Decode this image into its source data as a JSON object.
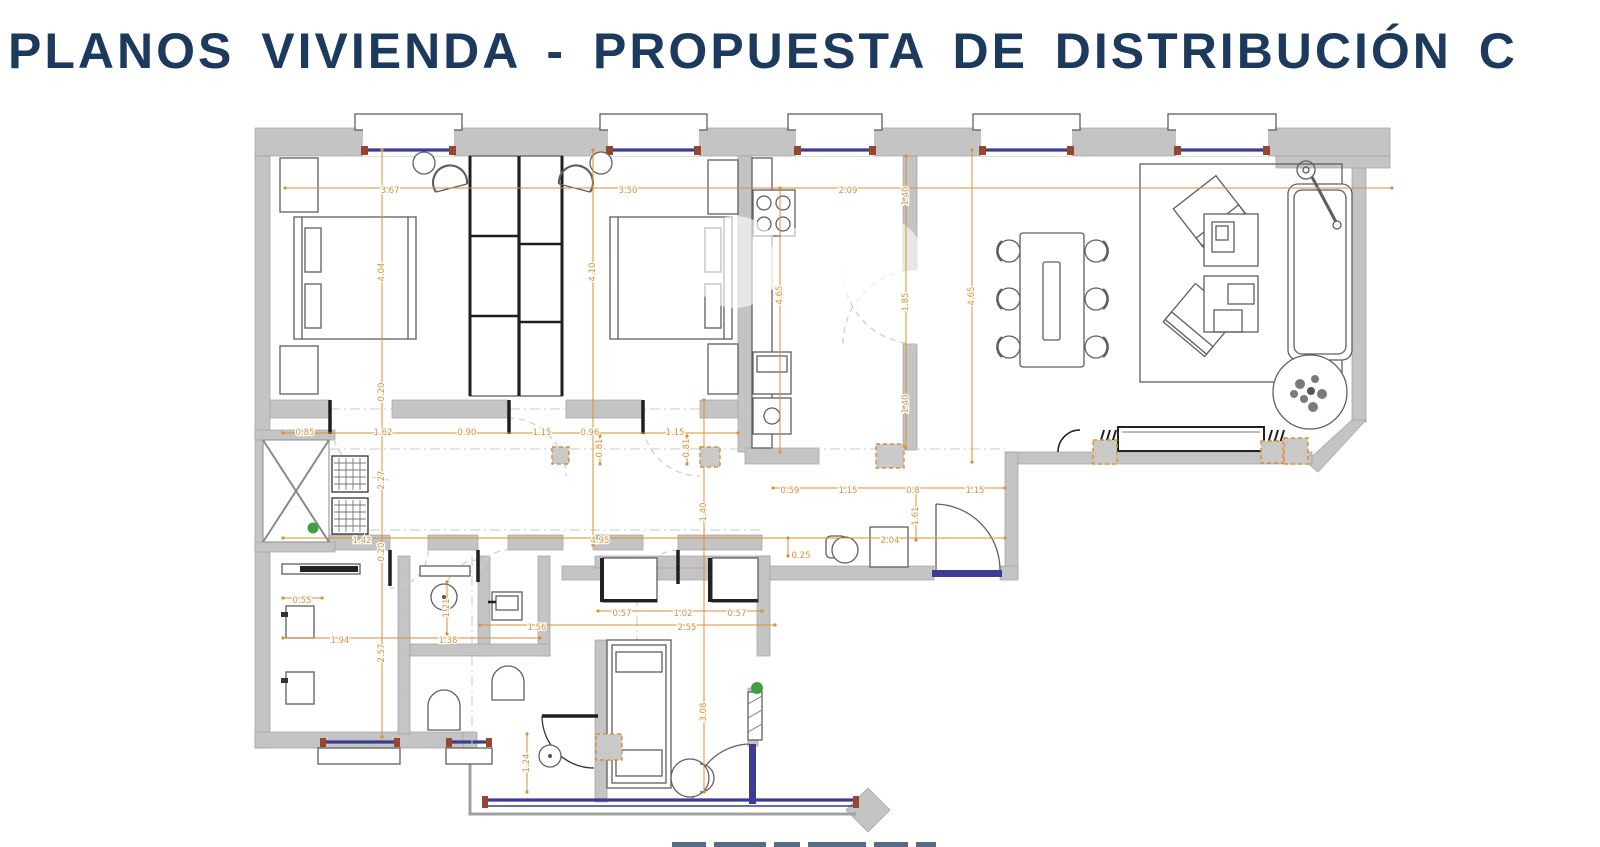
{
  "title": "PLANOS VIVIENDA - PROPUESTA DE DISTRIBUCIÓN C",
  "colors": {
    "title_navy": "#1c3a5e",
    "wall_gray": "#c4c4c4",
    "dimension_orange": "#dd8f33",
    "glazing_blue": "#3c3c96",
    "frame_maroon": "#96452f",
    "accent_green": "#3da23d"
  },
  "plan": {
    "dimensions": [
      {
        "t": "3.67",
        "x": 390,
        "y": 191
      },
      {
        "t": "3.50",
        "x": 628,
        "y": 191
      },
      {
        "t": "2.09",
        "x": 848,
        "y": 191
      },
      {
        "t": "4.04",
        "x": 382,
        "y": 272,
        "rot": 1
      },
      {
        "t": "0.20",
        "x": 382,
        "y": 392,
        "rot": 1
      },
      {
        "t": "2.27",
        "x": 382,
        "y": 480,
        "rot": 1
      },
      {
        "t": "0.20",
        "x": 382,
        "y": 552,
        "rot": 1
      },
      {
        "t": "2.57",
        "x": 382,
        "y": 653,
        "rot": 1
      },
      {
        "t": "4.10",
        "x": 593,
        "y": 272,
        "rot": 1
      },
      {
        "t": "1.40",
        "x": 906,
        "y": 196,
        "rot": 1
      },
      {
        "t": "1.85",
        "x": 906,
        "y": 302,
        "rot": 1
      },
      {
        "t": "1.40",
        "x": 906,
        "y": 404,
        "rot": 1
      },
      {
        "t": "4.65",
        "x": 780,
        "y": 295,
        "rot": 1
      },
      {
        "t": "4.65",
        "x": 972,
        "y": 296,
        "rot": 1
      },
      {
        "t": "0.85",
        "x": 305,
        "y": 433
      },
      {
        "t": "1.62",
        "x": 383,
        "y": 433
      },
      {
        "t": "0.90",
        "x": 467,
        "y": 433
      },
      {
        "t": "1.15",
        "x": 542,
        "y": 433
      },
      {
        "t": "0.96",
        "x": 590,
        "y": 433
      },
      {
        "t": "1.15",
        "x": 675,
        "y": 433
      },
      {
        "t": "0.81",
        "x": 600,
        "y": 448,
        "rot": 1
      },
      {
        "t": "0.81",
        "x": 687,
        "y": 448,
        "rot": 1
      },
      {
        "t": "1.40",
        "x": 704,
        "y": 512,
        "rot": 1
      },
      {
        "t": "3.08",
        "x": 704,
        "y": 712,
        "rot": 1
      },
      {
        "t": "1.24",
        "x": 527,
        "y": 763,
        "rot": 1
      },
      {
        "t": "1.61",
        "x": 916,
        "y": 516,
        "rot": 1
      },
      {
        "t": "0.59",
        "x": 790,
        "y": 491
      },
      {
        "t": "1.15",
        "x": 848,
        "y": 491
      },
      {
        "t": "0.8",
        "x": 913,
        "y": 491
      },
      {
        "t": "1.15",
        "x": 975,
        "y": 491
      },
      {
        "t": "1.42",
        "x": 362,
        "y": 541
      },
      {
        "t": "4.95",
        "x": 600,
        "y": 541
      },
      {
        "t": "2.04",
        "x": 890,
        "y": 541
      },
      {
        "t": "0.25",
        "x": 801,
        "y": 556
      },
      {
        "t": "0.55",
        "x": 302,
        "y": 601
      },
      {
        "t": "1.94",
        "x": 340,
        "y": 641
      },
      {
        "t": "1.38",
        "x": 448,
        "y": 641
      },
      {
        "t": "1.21",
        "x": 447,
        "y": 608,
        "rot": 1
      },
      {
        "t": "1.56",
        "x": 537,
        "y": 628
      },
      {
        "t": "2.55",
        "x": 687,
        "y": 628
      },
      {
        "t": "0.57",
        "x": 622,
        "y": 614
      },
      {
        "t": "1.02",
        "x": 683,
        "y": 614
      },
      {
        "t": "0.57",
        "x": 737,
        "y": 614
      }
    ],
    "dim_lines": [
      [
        285,
        188,
        1392,
        188
      ],
      [
        382,
        150,
        382,
        737
      ],
      [
        593,
        150,
        593,
        545
      ],
      [
        906,
        156,
        906,
        448
      ],
      [
        780,
        188,
        780,
        452
      ],
      [
        972,
        150,
        972,
        462
      ],
      [
        283,
        433,
        738,
        433
      ],
      [
        600,
        436,
        600,
        464
      ],
      [
        687,
        436,
        687,
        464
      ],
      [
        704,
        400,
        704,
        792
      ],
      [
        773,
        488,
        1005,
        488
      ],
      [
        916,
        492,
        916,
        540
      ],
      [
        283,
        538,
        1005,
        538
      ],
      [
        788,
        538,
        788,
        556
      ],
      [
        283,
        598,
        322,
        598
      ],
      [
        283,
        638,
        540,
        638
      ],
      [
        447,
        582,
        447,
        634
      ],
      [
        598,
        611,
        762,
        611
      ],
      [
        480,
        625,
        775,
        625
      ],
      [
        527,
        734,
        527,
        792
      ]
    ],
    "column_markers": [
      [
        552,
        447,
        17,
        17
      ],
      [
        700,
        447,
        20,
        20
      ],
      [
        876,
        444,
        28,
        24
      ],
      [
        1093,
        440,
        24,
        24
      ],
      [
        1261,
        441,
        22,
        22
      ],
      [
        1284,
        438,
        24,
        26
      ],
      [
        596,
        734,
        26,
        26
      ]
    ]
  }
}
